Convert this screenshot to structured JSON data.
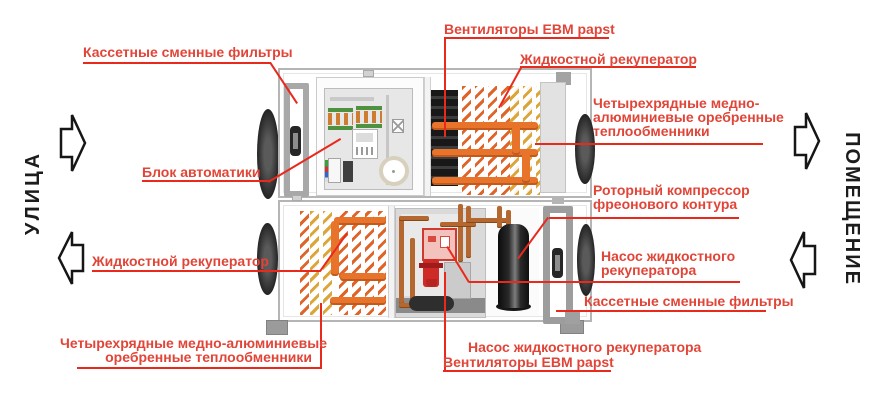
{
  "side_labels": {
    "street": "УЛИЦА",
    "premises": "ПОМЕЩЕНИЕ"
  },
  "labels": {
    "filters_top": "Кассетные сменные фильтры",
    "fans_top": "Вентиляторы EBM papst",
    "liquid_recuperator_top": "Жидкостной рекуператор",
    "hx_right_line1": "Четырехрядные медно-",
    "hx_right_line2": "алюминиевые оребренные",
    "hx_right_line3": "теплообменники",
    "compressor_line1": "Роторный компрессор",
    "compressor_line2": "фреонового контура",
    "pump_right_line1": "Насос жидкостного",
    "pump_right_line2": "рекуператора",
    "filters_right": "Кассетные сменные фильтры",
    "pump_bottom": "Насос жидкостного рекуператора",
    "fans_bottom": "Вентиляторы EBM papst",
    "automation": "Блок автоматики",
    "liquid_recuperator_left": "Жидкостной рекуператор",
    "hx_bottom_line1": "Четырехрядные медно-алюминиевые",
    "hx_bottom_line2": "оребренные теплообменники"
  },
  "colors": {
    "label_red": "#e14538",
    "line_red": "#e8291c",
    "coil_orange": "#df6429",
    "coil_yellow": "#d9a637",
    "pipe_orange": "#e8742c",
    "copper": "#b4682f",
    "pump_red": "#ce2a27",
    "casing_gray": "#b5b5b5",
    "text_black": "#1c1c1c"
  }
}
